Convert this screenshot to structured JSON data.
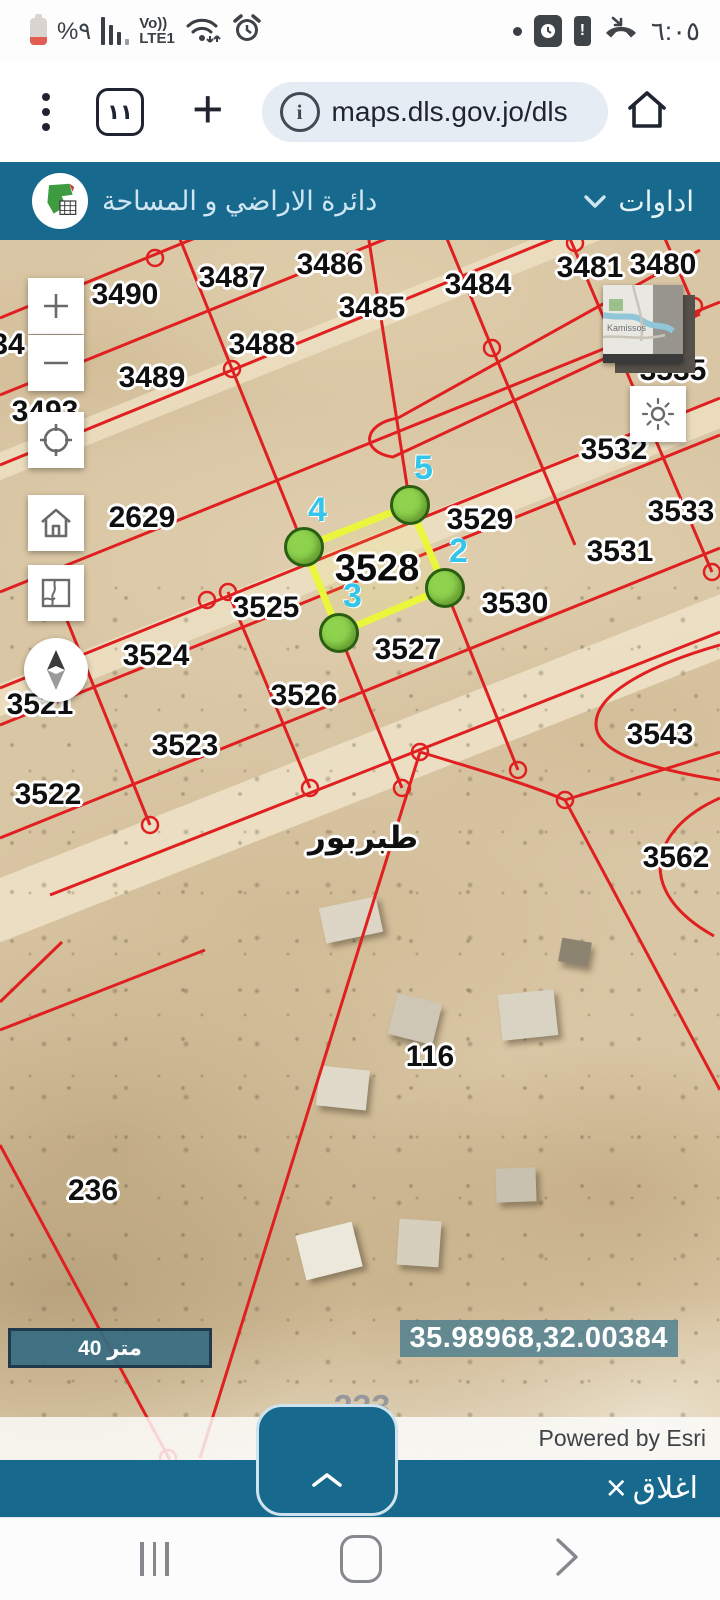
{
  "status_bar": {
    "battery_percent": "%٩",
    "volte_label": "Vo))",
    "network_label": "LTE1",
    "time": "٦:٠٥",
    "icons": [
      "battery-low-icon",
      "signal-bars-icon",
      "wifi-icon",
      "alarm-icon",
      "notification-dot-icon",
      "screen-capture-icon",
      "battery-alert-icon",
      "missed-call-icon"
    ]
  },
  "browser": {
    "tab_count": "١١",
    "url": "maps.dls.gov.jo/dls",
    "icons": [
      "kebab-menu-icon",
      "tab-switcher-icon",
      "new-tab-icon",
      "page-info-icon",
      "home-icon"
    ]
  },
  "header": {
    "title": "دائرة الاراضي و المساحة",
    "tools_label": "اداوات"
  },
  "map": {
    "parcels": [
      {
        "text": "3490",
        "x": 125,
        "y": 55
      },
      {
        "text": "3487",
        "x": 232,
        "y": 38
      },
      {
        "text": "3486",
        "x": 330,
        "y": 25
      },
      {
        "text": "3485",
        "x": 372,
        "y": 68
      },
      {
        "text": "3484",
        "x": 478,
        "y": 45
      },
      {
        "text": "3481",
        "x": 590,
        "y": 28
      },
      {
        "text": "3480",
        "x": 663,
        "y": 25
      },
      {
        "text": "3488",
        "x": 262,
        "y": 105
      },
      {
        "text": "3489",
        "x": 152,
        "y": 138
      },
      {
        "text": "34",
        "x": 8,
        "y": 105
      },
      {
        "text": "3493",
        "x": 45,
        "y": 172
      },
      {
        "text": "3535",
        "x": 673,
        "y": 131
      },
      {
        "text": "3532",
        "x": 614,
        "y": 210
      },
      {
        "text": "2629",
        "x": 142,
        "y": 278
      },
      {
        "text": "3529",
        "x": 480,
        "y": 280
      },
      {
        "text": "3533",
        "x": 681,
        "y": 272
      },
      {
        "text": "3531",
        "x": 620,
        "y": 312
      },
      {
        "text": "3525",
        "x": 266,
        "y": 368
      },
      {
        "text": "3530",
        "x": 515,
        "y": 364
      },
      {
        "text": "3524",
        "x": 156,
        "y": 416
      },
      {
        "text": "3527",
        "x": 408,
        "y": 410
      },
      {
        "text": "3526",
        "x": 304,
        "y": 456
      },
      {
        "text": "3521",
        "x": 40,
        "y": 465
      },
      {
        "text": "3523",
        "x": 185,
        "y": 506
      },
      {
        "text": "3543",
        "x": 660,
        "y": 495
      },
      {
        "text": "3522",
        "x": 48,
        "y": 555
      },
      {
        "text": "طبربور",
        "x": 363,
        "y": 598,
        "cls": "town"
      },
      {
        "text": "3562",
        "x": 676,
        "y": 618
      },
      {
        "text": "116",
        "x": 430,
        "y": 817
      },
      {
        "text": "236",
        "x": 93,
        "y": 951
      },
      {
        "text": "233",
        "x": 362,
        "y": 1168,
        "cls": "faded"
      }
    ],
    "selected_parcel": {
      "number": "3528",
      "vertices": [
        {
          "n": "2",
          "x": 445,
          "y": 348
        },
        {
          "n": "3",
          "x": 339,
          "y": 393
        },
        {
          "n": "4",
          "x": 304,
          "y": 307
        },
        {
          "n": "5",
          "x": 410,
          "y": 265
        }
      ]
    },
    "scale_bar_label": "40 متر",
    "coordinates": "35.98968,32.00384",
    "attribution": "Powered by Esri",
    "overview_place": "Kamissos",
    "control_icons": [
      "zoom-in-icon",
      "zoom-out-icon",
      "locate-icon",
      "home-extent-icon",
      "basemap-icon",
      "compass-icon",
      "sun-basemap-icon"
    ]
  },
  "bottom_bar": {
    "close_label": "اغلاق"
  },
  "colors": {
    "header_teal": "#176a8d",
    "map_line_red": "#e02020",
    "highlight_yellow": "#e9f63c",
    "vertex_green": "#8ed24e",
    "vertex_number_cyan": "#33c5ea",
    "url_pill_bg": "#e6ecf4",
    "sand": "#d9c6a4"
  }
}
